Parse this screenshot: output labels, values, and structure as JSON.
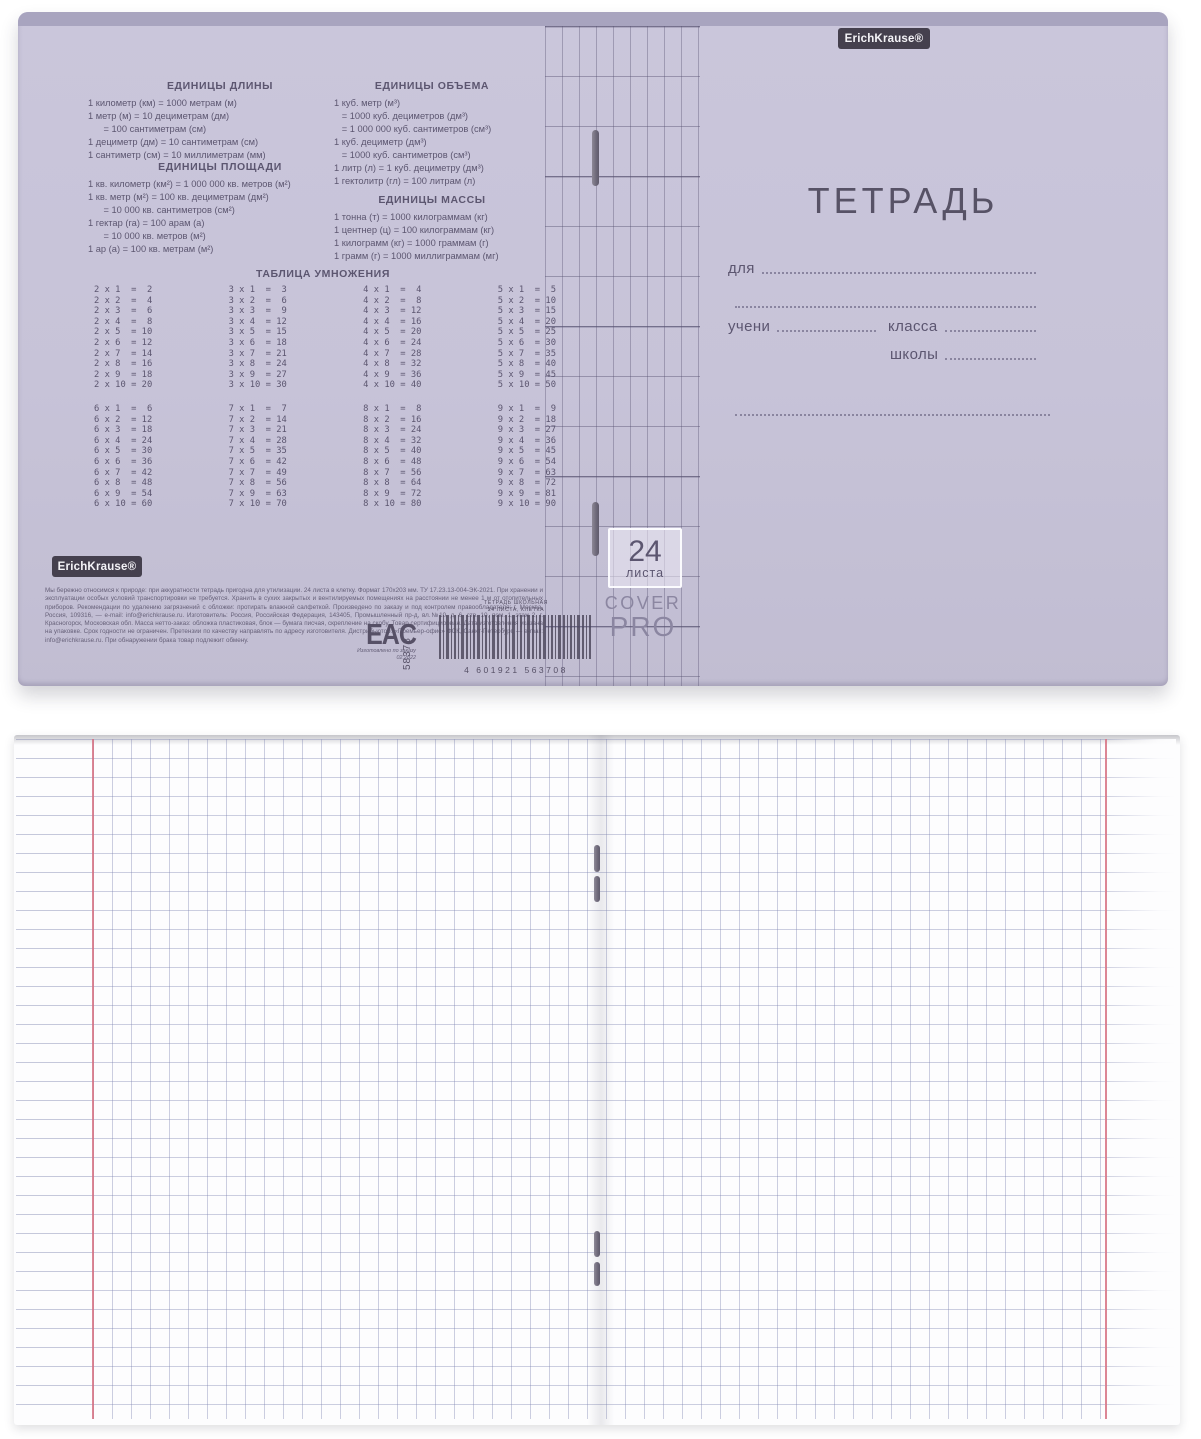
{
  "colors": {
    "cover_lavender": "#c7c3d8",
    "cover_top_strip": "#a8a4bf",
    "cover_text": "#5c5670",
    "margin_red": "#d67182",
    "grid_blue": "#8086b2"
  },
  "brand": {
    "logo_text": "ErichKrause®"
  },
  "cover": {
    "back": {
      "units_length": {
        "title": "ЕДИНИЦЫ ДЛИНЫ",
        "lines": [
          "1 километр (км) = 1000 метрам (м)",
          "1 метр (м) = 10 дециметрам (дм)",
          "      = 100 сантиметрам (см)",
          "1 дециметр (дм) = 10 сантиметрам (см)",
          "1 сантиметр (см) = 10 миллиметрам (мм)"
        ]
      },
      "units_area": {
        "title": "ЕДИНИЦЫ ПЛОЩАДИ",
        "lines": [
          "1 кв. километр (км²) = 1 000 000 кв. метров (м²)",
          "1 кв. метр (м²) = 100 кв. дециметрам (дм²)",
          "      = 10 000 кв. сантиметров (см²)",
          "1 гектар (га) = 100 арам (а)",
          "      = 10 000 кв. метров (м²)",
          "1 ар (а) = 100 кв. метрам (м²)"
        ]
      },
      "units_volume": {
        "title": "ЕДИНИЦЫ ОБЪЕМА",
        "lines": [
          "1 куб. метр (м³)",
          "   = 1000 куб. дециметров (дм³)",
          "   = 1 000 000 куб. сантиметров (см³)",
          "1 куб. дециметр (дм³)",
          "   = 1000 куб. сантиметров (см³)",
          "1 литр (л) = 1 куб. дециметру (дм³)",
          "1 гектолитр (гл) = 100 литрам (л)"
        ]
      },
      "units_mass": {
        "title": "ЕДИНИЦЫ МАССЫ",
        "lines": [
          "1 тонна (т) = 1000 килограммам (кг)",
          "1 центнер (ц) = 100 килограммам (кг)",
          "1 килограмм (кг) = 1000 граммам (г)",
          "1 грамм (г) = 1000 миллиграммам (мг)"
        ]
      },
      "multiplication": {
        "title": "ТАБЛИЦА УМНОЖЕНИЯ",
        "col2": [
          "2 х 1  =  2",
          "2 х 2  =  4",
          "2 х 3  =  6",
          "2 х 4  =  8",
          "2 х 5  = 10",
          "2 х 6  = 12",
          "2 х 7  = 14",
          "2 х 8  = 16",
          "2 х 9  = 18",
          "2 х 10 = 20"
        ],
        "col3": [
          "3 х 1  =  3",
          "3 х 2  =  6",
          "3 х 3  =  9",
          "3 х 4  = 12",
          "3 х 5  = 15",
          "3 х 6  = 18",
          "3 х 7  = 21",
          "3 х 8  = 24",
          "3 х 9  = 27",
          "3 х 10 = 30"
        ],
        "col4": [
          "4 х 1  =  4",
          "4 х 2  =  8",
          "4 х 3  = 12",
          "4 х 4  = 16",
          "4 х 5  = 20",
          "4 х 6  = 24",
          "4 х 7  = 28",
          "4 х 8  = 32",
          "4 х 9  = 36",
          "4 х 10 = 40"
        ],
        "col5": [
          "5 х 1  =  5",
          "5 х 2  = 10",
          "5 х 3  = 15",
          "5 х 4  = 20",
          "5 х 5  = 25",
          "5 х 6  = 30",
          "5 х 7  = 35",
          "5 х 8  = 40",
          "5 х 9  = 45",
          "5 х 10 = 50"
        ],
        "col6": [
          "6 х 1  =  6",
          "6 х 2  = 12",
          "6 х 3  = 18",
          "6 х 4  = 24",
          "6 х 5  = 30",
          "6 х 6  = 36",
          "6 х 7  = 42",
          "6 х 8  = 48",
          "6 х 9  = 54",
          "6 х 10 = 60"
        ],
        "col7": [
          "7 х 1  =  7",
          "7 х 2  = 14",
          "7 х 3  = 21",
          "7 х 4  = 28",
          "7 х 5  = 35",
          "7 х 6  = 42",
          "7 х 7  = 49",
          "7 х 8  = 56",
          "7 х 9  = 63",
          "7 х 10 = 70"
        ],
        "col8": [
          "8 х 1  =  8",
          "8 х 2  = 16",
          "8 х 3  = 24",
          "8 х 4  = 32",
          "8 х 5  = 40",
          "8 х 6  = 48",
          "8 х 7  = 56",
          "8 х 8  = 64",
          "8 х 9  = 72",
          "8 х 10 = 80"
        ],
        "col9": [
          "9 х 1  =  9",
          "9 х 2  = 18",
          "9 х 3  = 27",
          "9 х 4  = 36",
          "9 х 5  = 45",
          "9 х 6  = 54",
          "9 х 7  = 63",
          "9 х 8  = 72",
          "9 х 9  = 81",
          "9 х 10 = 90"
        ]
      },
      "fine_print": "Мы бережно относимся к природе: при аккуратности тетрадь пригодна для утилизации. 24 листа в клетку. Формат 170х203 мм. ТУ 17.23.13-004-ЭК-2021. При хранении и эксплуатации особых условий транспортировки не требуется. Хранить в сухих закрытых и вентилируемых помещениях на расстоянии не менее 1 м от отопительных приборов. Рекомендации по удалению загрязнений с обложки: протирать влажной салфеткой. Произведено по заказу и под контролем правообладателя: г. Москва, Россия, 109316, — е-mail: info@erichkrause.ru. Изготовитель: Россия, Российская Федерация, 143405, Промышленный пр-д, вл.№10, д. 6, стр. 10, пом. 1, этаж 2, г. Красногорск, Московская обл. Масса нетто-заказ: обложка пластиковая, блок — бумага писчая, скрепление на скобу. Товар сертифицирован. Дата изготовления указана на упаковке. Срок годности не ограничен. Претензии по качеству направлять по адресу изготовителя. Дистрибьютор: «Премьер-офис» ФСК, Санкт-Петербург, — e-mail: info@erichkrause.ru. При обнаружении брака товар подлежит обмену.",
      "eac_mark": "EAC",
      "article_number": "58378",
      "made_note": [
        "Изготовлено",
        "по заказу",
        "02.2022"
      ],
      "barcode": {
        "label_line1": "ТЕТРАДЬ ШКОЛЬНАЯ",
        "label_line2": "24 ЛИСТА, КЛЕТКА",
        "number": "4 601921 563708"
      }
    },
    "spine": {
      "sheets_number": "24",
      "sheets_word": "листа",
      "cover_line1": "COVER",
      "cover_line2": "PRO"
    },
    "front": {
      "title": "ТЕТРАДЬ",
      "for_label": "для",
      "student_label": "учени",
      "class_label": "класса",
      "school_label": "школы"
    }
  }
}
